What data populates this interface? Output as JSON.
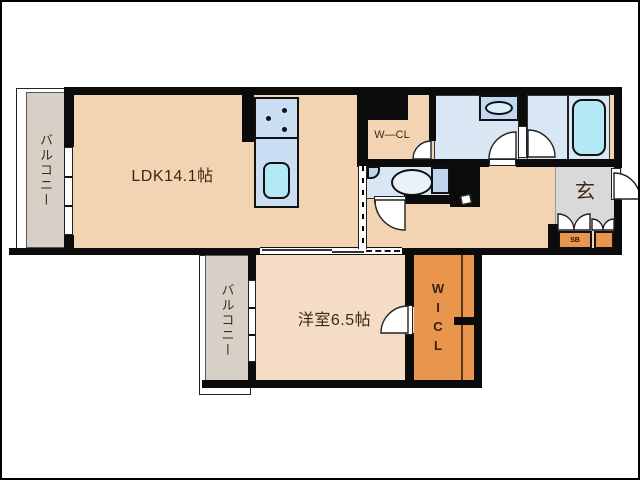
{
  "floorplan": {
    "type": "apartment-floor-plan",
    "rooms": {
      "ldk": {
        "label": "LDK14.1帖"
      },
      "bedroom": {
        "label": "洋室6.5帖"
      },
      "balcony_left": {
        "label": "バルコニー"
      },
      "balcony_bottom": {
        "label": "バルコニー"
      },
      "walk_in_closet_upper": {
        "label": "W—CL"
      },
      "walk_in_closet_lower": {
        "label": "WICL"
      },
      "entrance": {
        "label": "玄"
      },
      "shoe_box": {
        "label": "SB"
      }
    },
    "colors": {
      "ldk_fill": "#f3d4b2",
      "bedroom_fill": "#f5dcc4",
      "balcony_fill": "#d7d0c7",
      "entrance_fill": "#d9d9d9",
      "closet_orange": "#e8954e",
      "wet_room_blue": "#d9e6f4",
      "counter_blue": "#c9def2",
      "water_cyan": "#b2e9f4",
      "wall": "#0b0b0b"
    }
  }
}
